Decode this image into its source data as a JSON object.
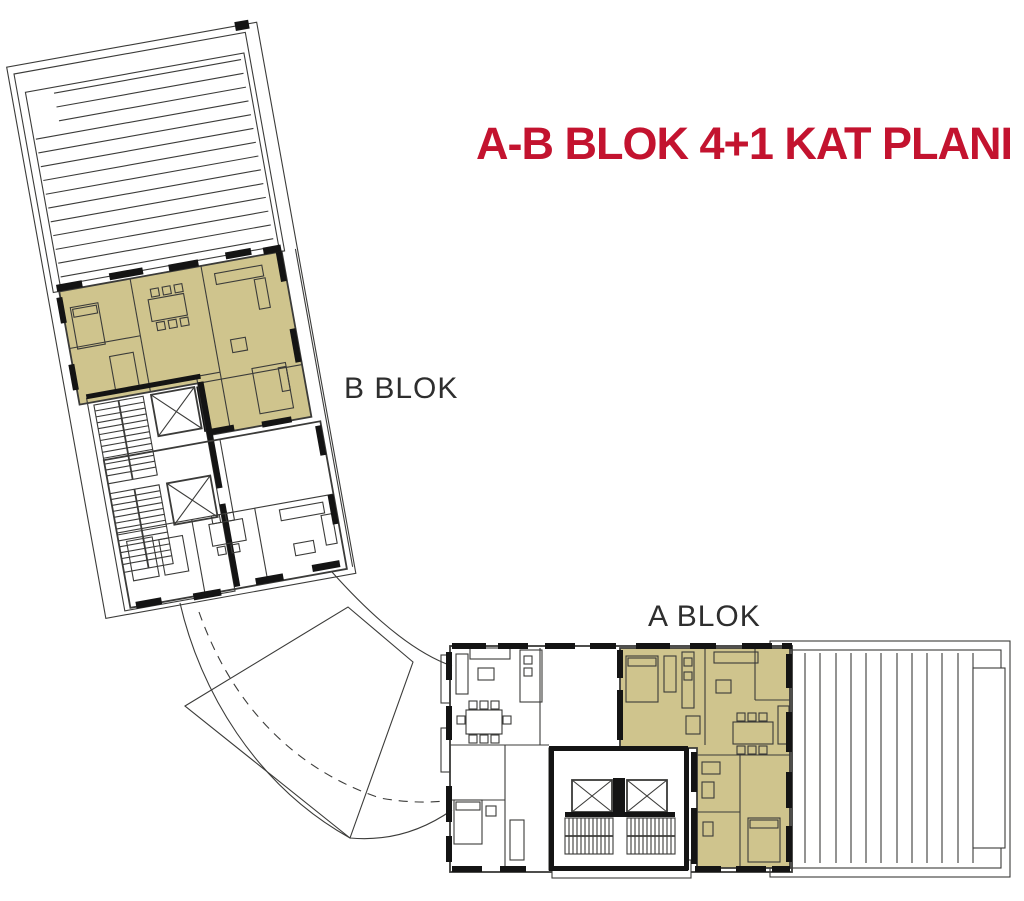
{
  "title": "A-B BLOK 4+1 KAT PLANI",
  "blocks": {
    "b": {
      "label": "B BLOK",
      "highlighted_unit": "4+1 apartment (olive)",
      "features": [
        "striped roof terrace",
        "stair core",
        "two elevator shafts",
        "second apartment"
      ]
    },
    "a": {
      "label": "A BLOK",
      "highlighted_unit": "4+1 apartment (olive)",
      "features": [
        "striped roof terrace",
        "two stair runs",
        "two elevator shafts",
        "second apartment"
      ]
    }
  },
  "site": {
    "connector": "curved dashed walkway between blocks",
    "plaza": "rotated quadrilateral courtyard"
  },
  "colors": {
    "title_red": "#C3132F",
    "unit_highlight_olive": "#CFC48D",
    "plan_line_dark": "#3B3B39",
    "wall_black": "#141414",
    "background_white": "#FFFFFF"
  }
}
